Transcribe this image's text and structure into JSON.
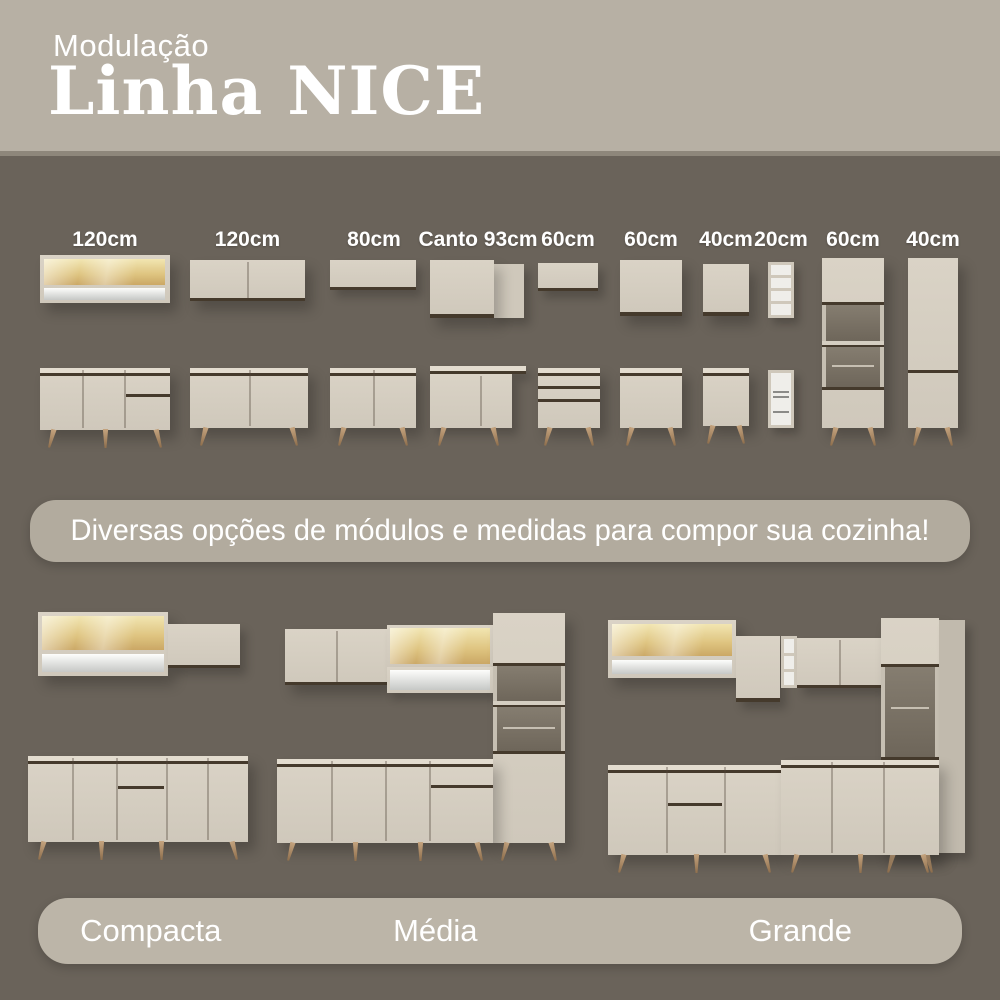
{
  "header": {
    "kicker": "Modulação",
    "title": "Linha NICE"
  },
  "modules": {
    "labels": [
      "120cm",
      "120cm",
      "80cm",
      "Canto 93cm",
      "60cm",
      "60cm",
      "40cm",
      "20cm",
      "60cm",
      "40cm"
    ]
  },
  "banner": {
    "text": "Diversas opções de módulos e medidas para compor sua cozinha!"
  },
  "kitchens": {
    "labels": [
      "Compacta",
      "Média",
      "Grande"
    ]
  },
  "colors": {
    "background": "#6a635a",
    "header_background": "#b7b0a4",
    "banner_background": "#b2ab9e",
    "footer_banner_background": "#bcb5a8",
    "cabinet": "#d5cec1",
    "trim": "#453a2c",
    "text": "#ffffff"
  }
}
